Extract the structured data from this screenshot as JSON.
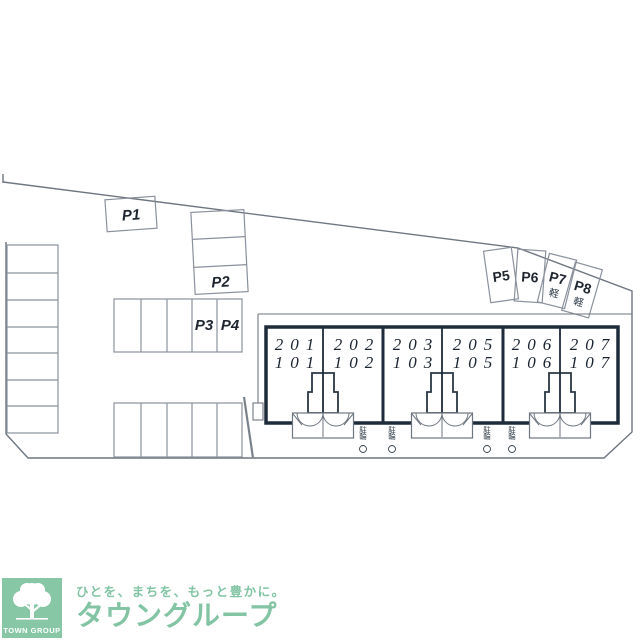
{
  "site_plan": {
    "parking": {
      "p1": "P1",
      "p2": "P2",
      "p3": "P3",
      "p4": "P4",
      "p5": "P5",
      "p6": "P6",
      "p7": "P7",
      "p8": "P8",
      "kei_label": "軽"
    },
    "units": [
      {
        "upper": "201",
        "lower": "101"
      },
      {
        "upper": "202",
        "lower": "102"
      },
      {
        "upper": "203",
        "lower": "103"
      },
      {
        "upper": "205",
        "lower": "105"
      },
      {
        "upper": "206",
        "lower": "106"
      },
      {
        "upper": "207",
        "lower": "107"
      }
    ],
    "bike_label": "駐輪"
  },
  "logo": {
    "tagline": "ひとを、まちを、もっと豊かに。",
    "brand": "タウングループ",
    "emblem_text": "TOWN GROUP"
  },
  "colors": {
    "brand_green": "#87c7a6",
    "building_line": "#1e2b3a",
    "parking_line": "#8a919c",
    "boundary_line": "#6e7680"
  }
}
